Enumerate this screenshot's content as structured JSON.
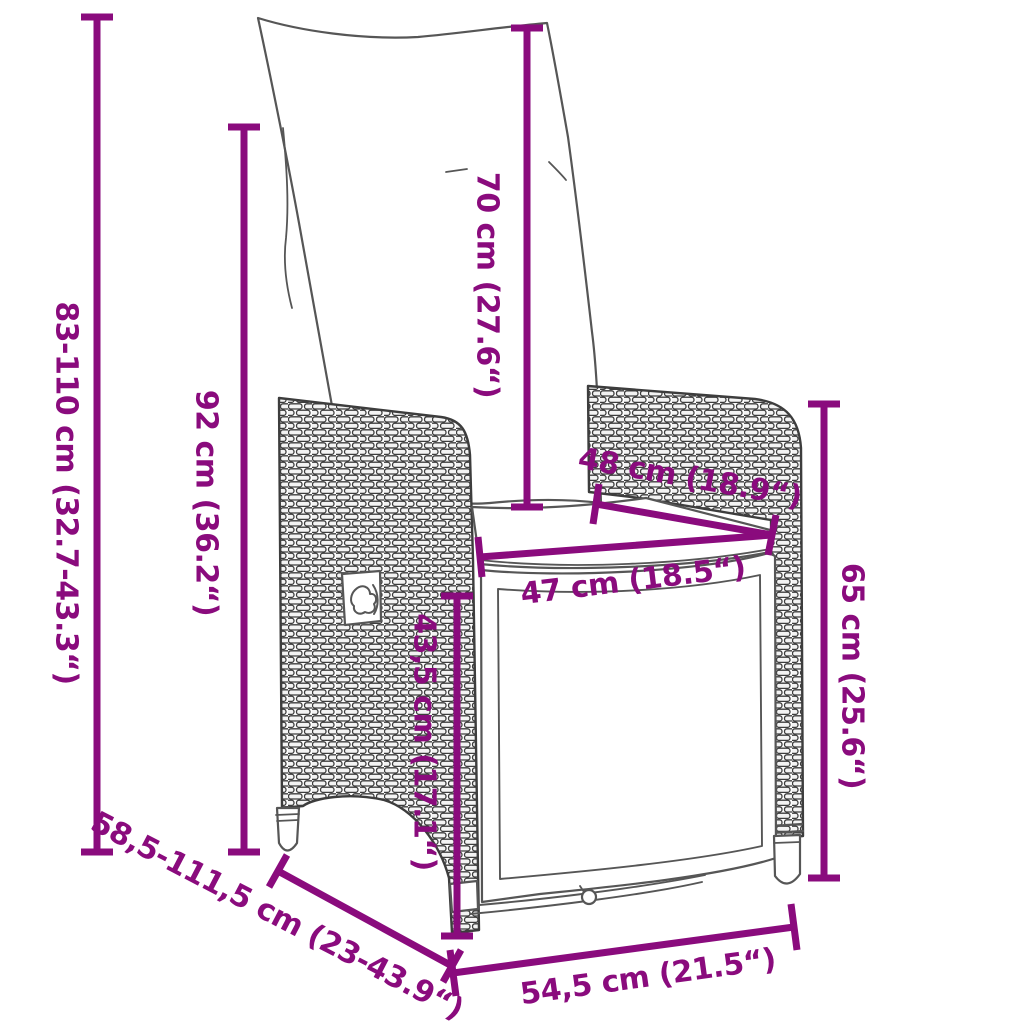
{
  "colors": {
    "accent": "#8A0B7D",
    "outline": "#4a4a4a"
  },
  "figure": {
    "description": "Reclining rattan garden chair with back and seat cushions — dimension diagram"
  },
  "labels": {
    "total_height": "83-110 cm (32.7-43.3“)",
    "backrest_height": "92 cm (36.2“)",
    "cushion_height": "70 cm (27.6“)",
    "armrest_height": "65 cm (25.6“)",
    "front_edge_height": "43,5 cm (17.1“)",
    "seat_width": "47 cm (18.5“)",
    "seat_depth": "48 cm (18.9“)",
    "base_width": "54,5 cm (21.5“)",
    "depth_range": "58,5-111,5 cm (23-43.9“)"
  }
}
